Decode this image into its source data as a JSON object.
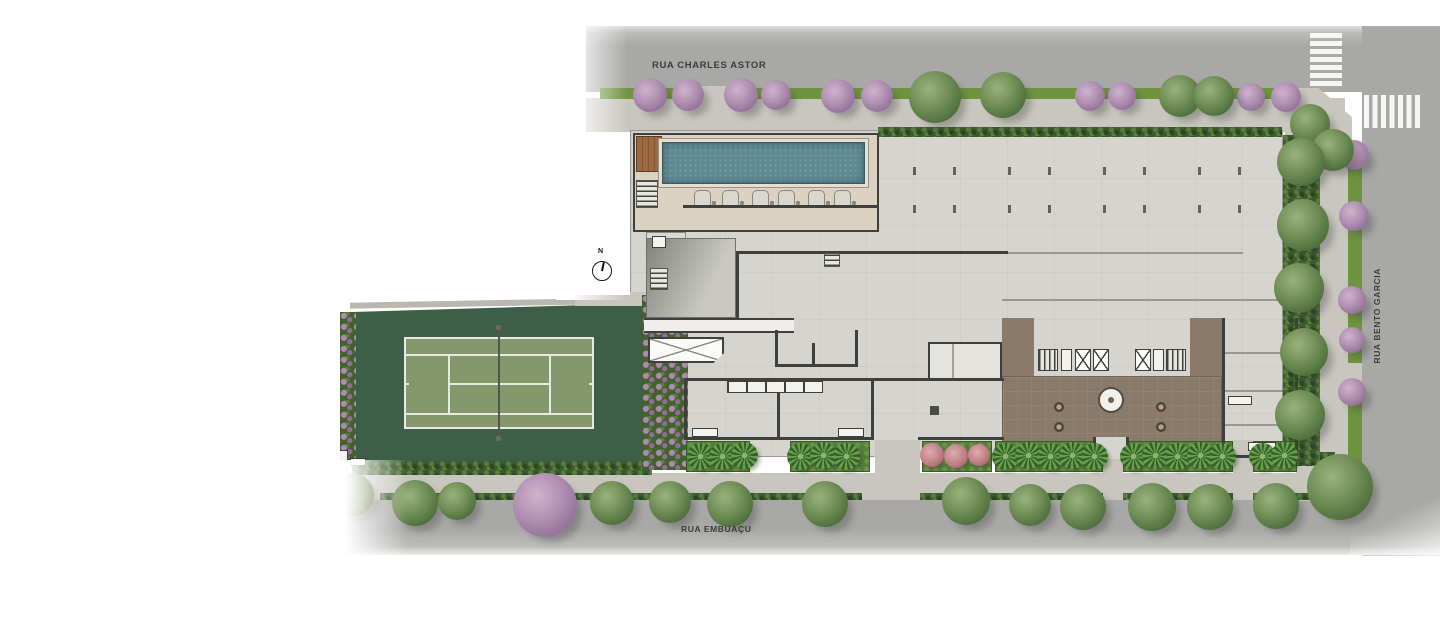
{
  "streets": {
    "top": {
      "label": "RUA CHARLES ASTOR"
    },
    "bottom": {
      "label": "RUA EMBUAÇU"
    },
    "right": {
      "label": "RUA BENTO GARCIA"
    }
  },
  "compass": {
    "label": "N"
  },
  "legend_colors": {
    "street": "#a8a8a6",
    "sidewalk": "#c8c6bf",
    "building_slab": "#d5d4ce",
    "pool_water": "#5d8a93",
    "pool_deck": "#dbd2c1",
    "wood_deck": "#9c6a42",
    "tennis_outer": "#3e5f47",
    "tennis_inner": "#85986d",
    "court_lines": "#e9e9e3",
    "lobby_floor": "#8b7a6a",
    "wall": "#3f3f3d",
    "grass_verge": "#6f943f",
    "hedge": "#3c5a2e",
    "tree_green": "#5c7f49",
    "tree_purple": "#a888ac",
    "palm": "#4e7a38",
    "bush_pink": "#bf7e84"
  },
  "features": [
    "swimming-pool",
    "pool-deck",
    "wood-deck",
    "tennis-court",
    "lobby",
    "elevator-core",
    "fountain",
    "ramp",
    "water-tank",
    "crosswalks"
  ],
  "vegetation": {
    "purple_trees": [
      [
        650,
        95,
        34
      ],
      [
        688,
        95,
        32
      ],
      [
        741,
        95,
        34
      ],
      [
        776,
        95,
        30
      ],
      [
        838,
        96,
        34
      ],
      [
        877,
        96,
        32
      ],
      [
        1090,
        96,
        30
      ],
      [
        1122,
        96,
        28
      ],
      [
        1251,
        97,
        28
      ],
      [
        1286,
        97,
        30
      ],
      [
        1354,
        155,
        30
      ],
      [
        1354,
        216,
        30
      ],
      [
        1352,
        300,
        28
      ],
      [
        1352,
        340,
        26
      ],
      [
        1352,
        392,
        28
      ],
      [
        545,
        505,
        64
      ]
    ],
    "green_trees": [
      [
        935,
        97,
        52
      ],
      [
        1003,
        95,
        46
      ],
      [
        1180,
        96,
        42
      ],
      [
        1214,
        96,
        40
      ],
      [
        1310,
        124,
        40
      ],
      [
        1333,
        150,
        42
      ],
      [
        1301,
        162,
        48
      ],
      [
        1303,
        225,
        52
      ],
      [
        1299,
        288,
        50
      ],
      [
        1304,
        352,
        48
      ],
      [
        1300,
        415,
        50
      ],
      [
        415,
        503,
        46
      ],
      [
        457,
        501,
        38
      ],
      [
        612,
        503,
        44
      ],
      [
        670,
        502,
        42
      ],
      [
        730,
        504,
        46
      ],
      [
        825,
        504,
        46
      ],
      [
        966,
        501,
        48
      ],
      [
        1030,
        505,
        42
      ],
      [
        1083,
        507,
        46
      ],
      [
        1152,
        507,
        48
      ],
      [
        1210,
        507,
        46
      ],
      [
        1276,
        506,
        46
      ],
      [
        1340,
        487,
        66
      ],
      [
        352,
        495,
        44
      ]
    ],
    "palms": [
      [
        700,
        456
      ],
      [
        722,
        456
      ],
      [
        744,
        455
      ],
      [
        800,
        456
      ],
      [
        823,
        455
      ],
      [
        846,
        456
      ],
      [
        1005,
        456
      ],
      [
        1028,
        455
      ],
      [
        1050,
        456
      ],
      [
        1072,
        455
      ],
      [
        1094,
        456
      ],
      [
        1133,
        456
      ],
      [
        1155,
        455
      ],
      [
        1177,
        456
      ],
      [
        1200,
        455
      ],
      [
        1222,
        456
      ],
      [
        1262,
        456
      ],
      [
        1284,
        455
      ]
    ],
    "pink_bushes": [
      [
        932,
        455,
        24
      ],
      [
        956,
        456,
        24
      ],
      [
        979,
        455,
        22
      ]
    ]
  },
  "pool": {
    "loungers_x": [
      694,
      722,
      752,
      778,
      808,
      834
    ]
  }
}
